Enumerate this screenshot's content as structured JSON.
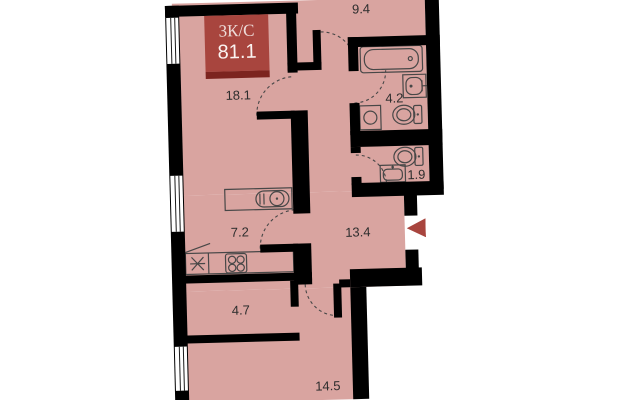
{
  "plan": {
    "badge": {
      "type_label": "3К/С",
      "area_value": "81.1"
    },
    "rooms": [
      {
        "label": "9.4"
      },
      {
        "label": "18.1"
      },
      {
        "label": "4.2"
      },
      {
        "label": "1.9"
      },
      {
        "label": "7.2"
      },
      {
        "label": "13.4"
      },
      {
        "label": "4.7"
      },
      {
        "label": "14.5"
      }
    ],
    "fixtures": [
      "bathtub-icon",
      "sink-icon",
      "toilet-icon",
      "washing-machine-icon",
      "hob-icon",
      "kitchen-sink-icon",
      "fridge-star-icon",
      "entrance-arrow-icon",
      "window-icon",
      "door-swing-arc"
    ],
    "colors": {
      "background": "#ffffff",
      "floor": "#d9a4a0",
      "wall": "#000000",
      "accent": "#a8453e",
      "accent-dark": "#7c241f",
      "outline": "#474747"
    }
  }
}
